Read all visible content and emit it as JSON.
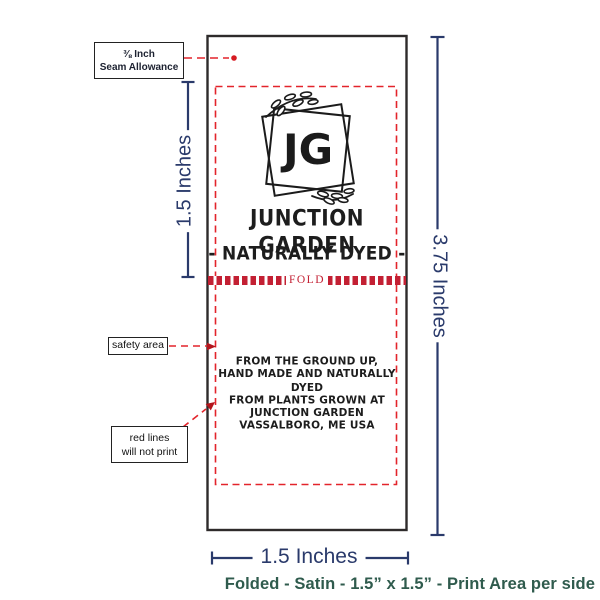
{
  "colors": {
    "dimension_navy": "#2a3a6b",
    "guide_red": "#e3242b",
    "fold_crimson": "#c32033",
    "label_ink": "#1d1d1d",
    "caption_teal": "#2f5b4d"
  },
  "annotations": {
    "seam": {
      "line1": "⅜ Inch",
      "line2": "Seam Allowance"
    },
    "safety_label": "safety area",
    "redlines": {
      "line1": "red lines",
      "line2": "will not print"
    },
    "dim_left": "1.5 Inches",
    "dim_right": "3.75 Inches",
    "dim_bottom": "1.5 Inches",
    "caption": "Folded - Satin - 1.5” x 1.5” - Print Area per side"
  },
  "label": {
    "monogram": "JG",
    "title": "JUNCTION GARDEN",
    "subtitle": "- NATURALLY DYED -",
    "fold": "FOLD",
    "body_lines": [
      "FROM THE GROUND UP,",
      "HAND MADE AND NATURALLY DYED",
      "FROM PLANTS GROWN AT",
      "JUNCTION GARDEN",
      "VASSALBORO, ME USA"
    ]
  }
}
